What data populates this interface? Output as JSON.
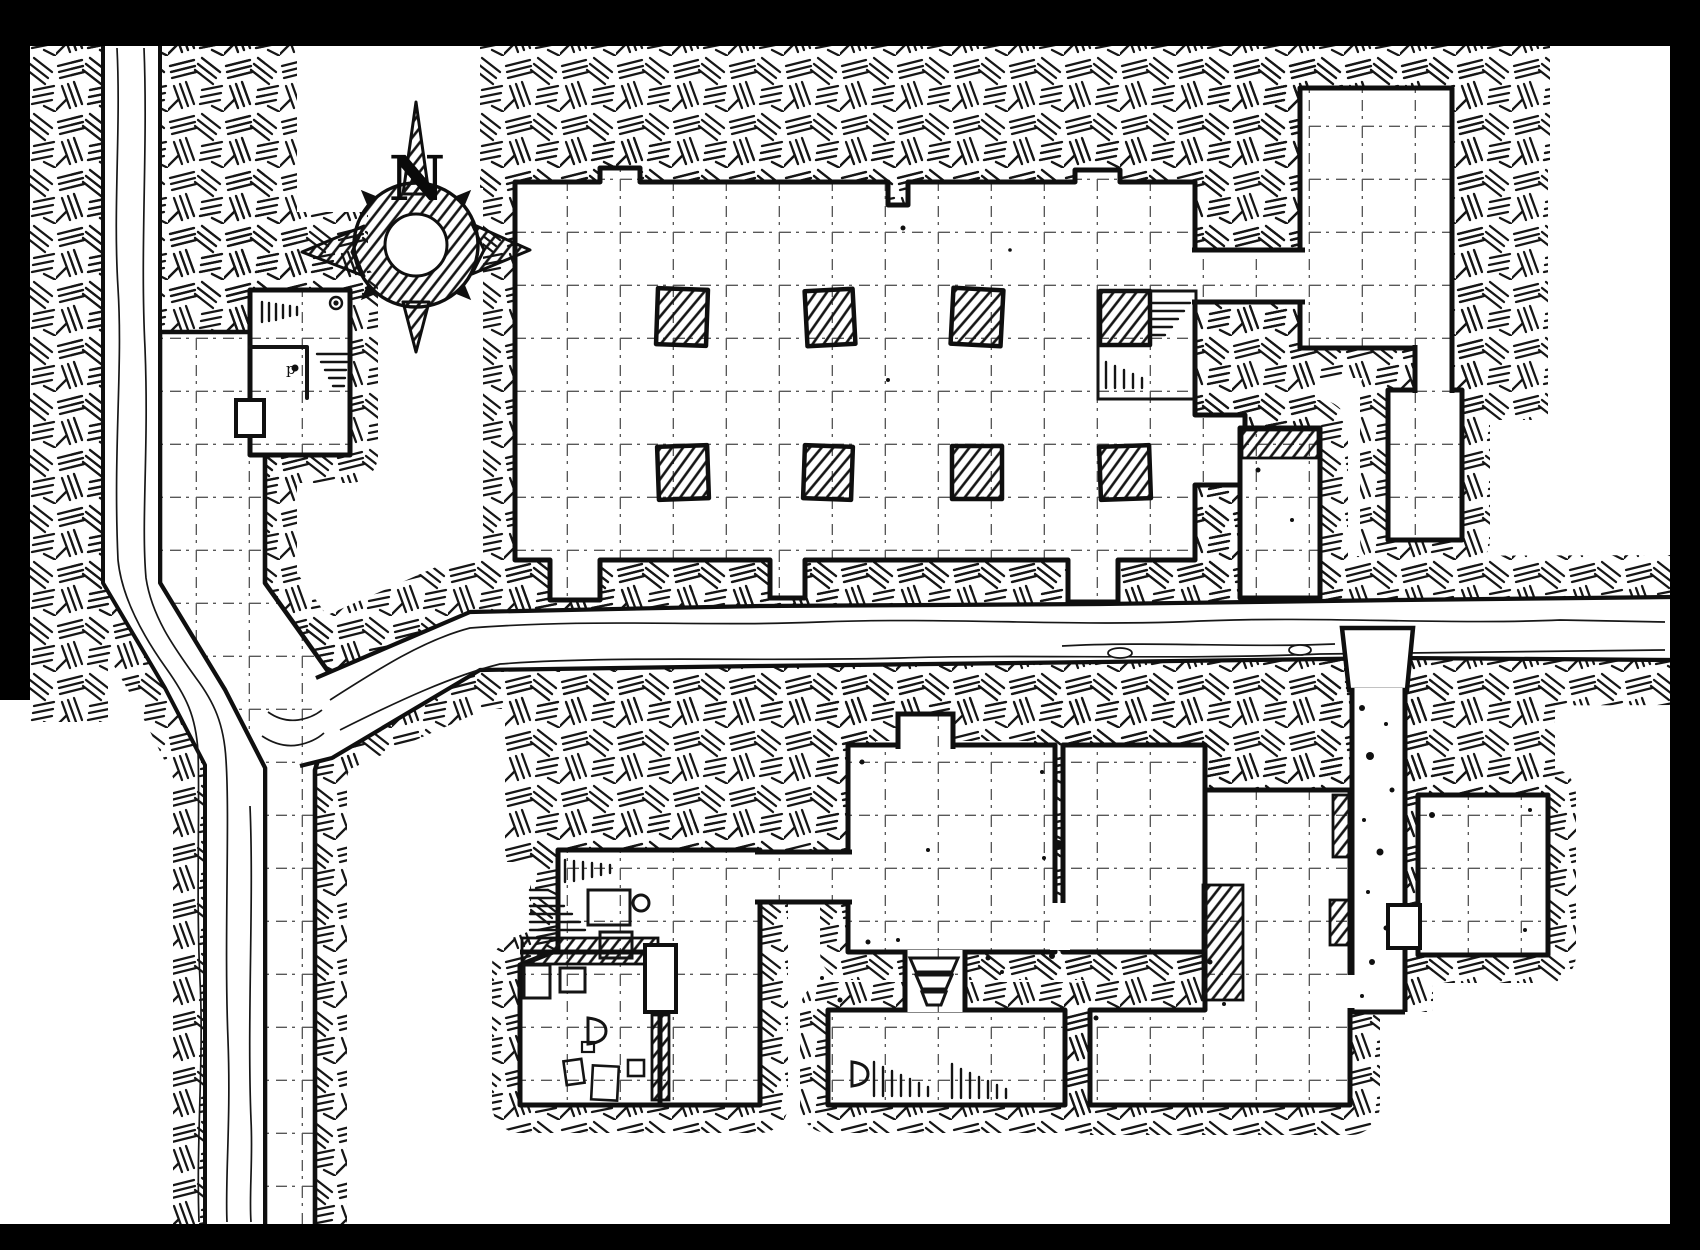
{
  "map": {
    "type": "hand-drawn dungeon floorplan",
    "compass": {
      "north_label": "N"
    },
    "marks": {
      "building_letter": "p"
    },
    "palette": {
      "ink": "#101010",
      "paper": "#ffffff",
      "frame": "#000000"
    },
    "grid_cell_px": 53,
    "features": [
      "compass-rose",
      "vertical-stream",
      "vertical-road",
      "horizontal-stream",
      "gatehouse-building",
      "great-pillared-hall",
      "northeast-room",
      "east-narrow-room",
      "east-stair-room",
      "storeroom-west",
      "lower-hall-west",
      "lower-hall-east",
      "shelf-room-south",
      "rubble-corridor",
      "southeast-room",
      "southeast-annex",
      "stairs-down",
      "pillars",
      "rubble",
      "door-symbols"
    ]
  }
}
